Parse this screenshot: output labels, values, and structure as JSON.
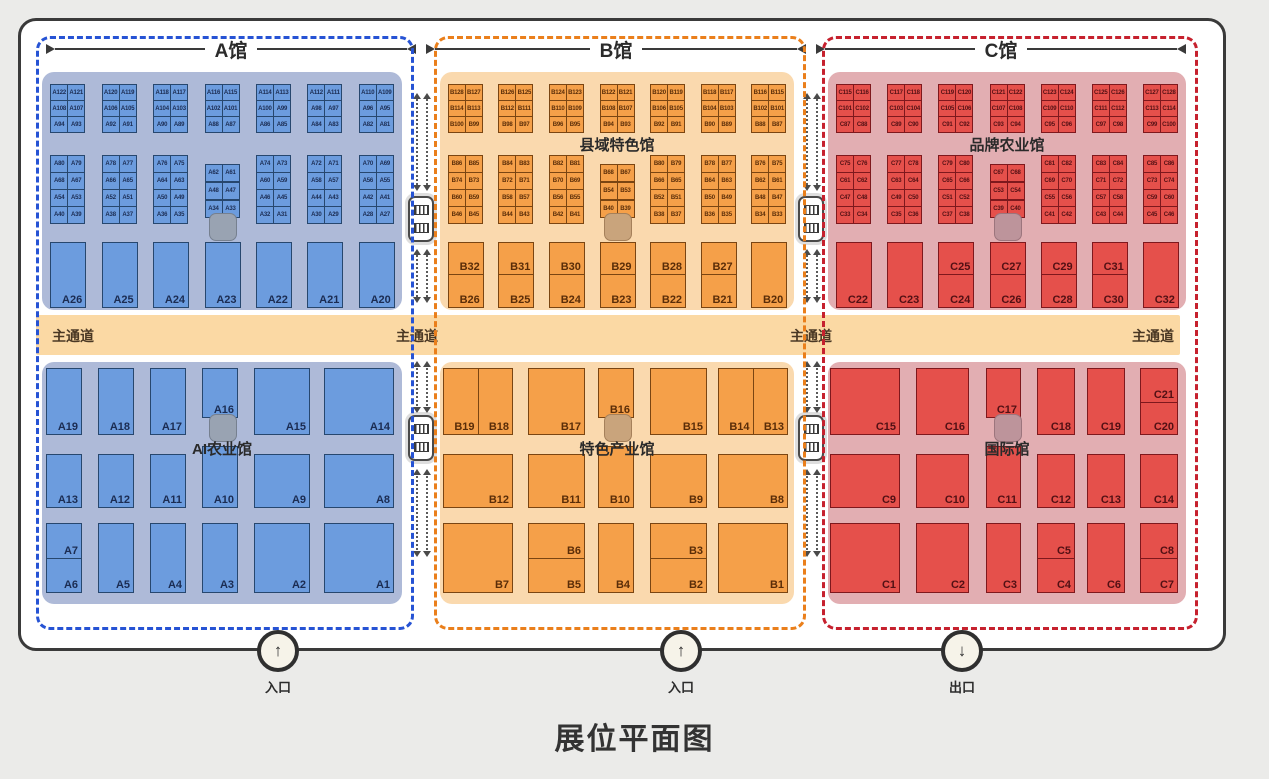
{
  "title": "展位平面图",
  "aisle": {
    "label": "主通道",
    "color": "#fbd9a4",
    "label_x": [
      16,
      360,
      754
    ],
    "label_right": 6
  },
  "corridors": {
    "x": [
      421,
      811
    ],
    "stairs_icon": "escalator-icon",
    "arrows_icon": "two-way-arrow-icon"
  },
  "entrances": [
    {
      "label": "入口",
      "direction": "up",
      "arrow": "↑",
      "x": 278
    },
    {
      "label": "入口",
      "direction": "up",
      "arrow": "↑",
      "x": 681
    },
    {
      "label": "出口",
      "direction": "down",
      "arrow": "↓",
      "x": 962
    }
  ],
  "halls": [
    {
      "id": "A",
      "name": "A馆",
      "x": 36,
      "w": 372,
      "colors": {
        "dash": "#2653d4",
        "region": "#aebad8",
        "booth": "#6c9cde",
        "booth_border": "#27476e",
        "text": "#1b2c52",
        "blob": "#99a3b2",
        "blob_border": "#76808f"
      },
      "top_hall_label": "",
      "bottom_hall_label": "AI农业馆",
      "cluster1_rows": [
        [
          "A122",
          "A121",
          "A120",
          "A119",
          "A118",
          "A117",
          "A116",
          "A115",
          "A114",
          "A113",
          "A112",
          "A111",
          "A110",
          "A109"
        ],
        [
          "A108",
          "A107",
          "A106",
          "A105",
          "A104",
          "A103",
          "A102",
          "A101",
          "A100",
          "A99",
          "A98",
          "A97",
          "A96",
          "A95"
        ],
        [
          "A94",
          "A93",
          "A92",
          "A91",
          "A90",
          "A89",
          "A88",
          "A87",
          "A86",
          "A85",
          "A84",
          "A83",
          "A82",
          "A81"
        ]
      ],
      "cluster2_rows": [
        [
          "A80",
          "A79",
          "A78",
          "A77",
          "A76",
          "A75",
          "A74",
          "A73",
          "A72",
          "A71",
          "A70",
          "A69"
        ],
        [
          "A68",
          "A67",
          "A66",
          "A65",
          "A64",
          "A63",
          "A60",
          "A59",
          "A58",
          "A57",
          "A56",
          "A55"
        ],
        [
          "A54",
          "A53",
          "A52",
          "A51",
          "A50",
          "A49",
          "A46",
          "A45",
          "A44",
          "A43",
          "A42",
          "A41"
        ],
        [
          "A40",
          "A39",
          "A38",
          "A37",
          "A36",
          "A35",
          "A32",
          "A31",
          "A30",
          "A29",
          "A28",
          "A27"
        ]
      ],
      "cluster2_middle": [
        [
          "A62",
          "A61"
        ],
        [
          "A48",
          "A47"
        ],
        [
          "A34",
          "A33"
        ]
      ],
      "big_row": [
        {
          "top": "",
          "bottom": "A26"
        },
        {
          "top": "",
          "bottom": "A25"
        },
        {
          "top": "",
          "bottom": "A24"
        },
        {
          "top": "",
          "bottom": "A23"
        },
        {
          "top": "",
          "bottom": "A22"
        },
        {
          "top": "",
          "bottom": "A21"
        },
        {
          "top": "",
          "bottom": "A20"
        }
      ],
      "bottom_cols": [
        {
          "x": 4,
          "w": 36
        },
        {
          "x": 56,
          "w": 36
        },
        {
          "x": 108,
          "w": 36
        },
        {
          "x": 160,
          "w": 36
        },
        {
          "x": 212,
          "w": 56
        },
        {
          "x": 282,
          "w": 70
        }
      ],
      "bottom_rows": [
        {
          "row": 0,
          "col": 0,
          "type": "full",
          "label": "A19"
        },
        {
          "row": 0,
          "col": 1,
          "type": "full",
          "label": "A18"
        },
        {
          "row": 0,
          "col": 2,
          "type": "full",
          "label": "A17"
        },
        {
          "row": 0,
          "col": 3,
          "type": "small",
          "label": "A16"
        },
        {
          "row": 0,
          "col": 4,
          "type": "full",
          "label": "A15"
        },
        {
          "row": 0,
          "col": 5,
          "type": "full",
          "label": "A14"
        },
        {
          "row": 1,
          "col": 0,
          "type": "full",
          "label": "A13"
        },
        {
          "row": 1,
          "col": 1,
          "type": "full",
          "label": "A12"
        },
        {
          "row": 1,
          "col": 2,
          "type": "full",
          "label": "A11"
        },
        {
          "row": 1,
          "col": 3,
          "type": "tall",
          "label": "A10"
        },
        {
          "row": 1,
          "col": 4,
          "type": "full",
          "label": "A9"
        },
        {
          "row": 1,
          "col": 5,
          "type": "full",
          "label": "A8"
        },
        {
          "row": 2,
          "col": 0,
          "type": "split_h",
          "labels": [
            "A7",
            "A6"
          ]
        },
        {
          "row": 2,
          "col": 1,
          "type": "full",
          "label": "A5"
        },
        {
          "row": 2,
          "col": 2,
          "type": "full",
          "label": "A4"
        },
        {
          "row": 2,
          "col": 3,
          "type": "full",
          "label": "A3"
        },
        {
          "row": 2,
          "col": 4,
          "type": "full",
          "label": "A2"
        },
        {
          "row": 2,
          "col": 5,
          "type": "full",
          "label": "A1"
        }
      ]
    },
    {
      "id": "B",
      "name": "B馆",
      "x": 434,
      "w": 366,
      "colors": {
        "dash": "#ea7f1b",
        "region": "#fad9ae",
        "booth": "#f5a049",
        "booth_border": "#7a4512",
        "text": "#5a2d08",
        "blob": "#c9a47c",
        "blob_border": "#a5805a"
      },
      "top_hall_label": "县域特色馆",
      "bottom_hall_label": "特色产业馆",
      "cluster1_rows": [
        [
          "B128",
          "B127",
          "B126",
          "B125",
          "B124",
          "B123",
          "B122",
          "B121",
          "B120",
          "B119",
          "B118",
          "B117",
          "B116",
          "B115"
        ],
        [
          "B114",
          "B113",
          "B112",
          "B111",
          "B110",
          "B109",
          "B108",
          "B107",
          "B106",
          "B105",
          "B104",
          "B103",
          "B102",
          "B101"
        ],
        [
          "B100",
          "B99",
          "B98",
          "B97",
          "B96",
          "B95",
          "B94",
          "B93",
          "B92",
          "B91",
          "B90",
          "B89",
          "B88",
          "B87"
        ]
      ],
      "cluster2_rows": [
        [
          "B86",
          "B85",
          "B84",
          "B83",
          "B82",
          "B81",
          "B80",
          "B79",
          "B78",
          "B77",
          "B76",
          "B75"
        ],
        [
          "B74",
          "B73",
          "B72",
          "B71",
          "B70",
          "B69",
          "B66",
          "B65",
          "B64",
          "B63",
          "B62",
          "B61"
        ],
        [
          "B60",
          "B59",
          "B58",
          "B57",
          "B56",
          "B55",
          "B52",
          "B51",
          "B50",
          "B49",
          "B48",
          "B47"
        ],
        [
          "B46",
          "B45",
          "B44",
          "B43",
          "B42",
          "B41",
          "B38",
          "B37",
          "B36",
          "B35",
          "B34",
          "B33"
        ]
      ],
      "cluster2_middle": [
        [
          "B68",
          "B67"
        ],
        [
          "B54",
          "B53"
        ],
        [
          "B40",
          "B39"
        ]
      ],
      "big_row": [
        {
          "top": "B32",
          "bottom": "B26"
        },
        {
          "top": "B31",
          "bottom": "B25"
        },
        {
          "top": "B30",
          "bottom": "B24"
        },
        {
          "top": "B29",
          "bottom": "B23"
        },
        {
          "top": "B28",
          "bottom": "B22"
        },
        {
          "top": "B27",
          "bottom": "B21"
        },
        {
          "top": "",
          "bottom": "B20"
        }
      ],
      "bottom_cols": [
        {
          "x": 3,
          "w": 70
        },
        {
          "x": 88,
          "w": 57
        },
        {
          "x": 158,
          "w": 36
        },
        {
          "x": 210,
          "w": 57
        },
        {
          "x": 278,
          "w": 70
        }
      ],
      "bottom_rows": [
        {
          "row": 0,
          "col": 0,
          "type": "split_v",
          "labels": [
            "B19",
            "B18"
          ]
        },
        {
          "row": 0,
          "col": 1,
          "type": "full",
          "label": "B17"
        },
        {
          "row": 0,
          "col": 2,
          "type": "small",
          "label": "B16"
        },
        {
          "row": 0,
          "col": 3,
          "type": "full",
          "label": "B15"
        },
        {
          "row": 0,
          "col": 4,
          "type": "split_v",
          "labels": [
            "B14",
            "B13"
          ]
        },
        {
          "row": 1,
          "col": 0,
          "type": "full",
          "label": "B12"
        },
        {
          "row": 1,
          "col": 1,
          "type": "full",
          "label": "B11"
        },
        {
          "row": 1,
          "col": 2,
          "type": "tall",
          "label": "B10"
        },
        {
          "row": 1,
          "col": 3,
          "type": "full",
          "label": "B9"
        },
        {
          "row": 1,
          "col": 4,
          "type": "full",
          "label": "B8"
        },
        {
          "row": 2,
          "col": 0,
          "type": "full",
          "label": "B7"
        },
        {
          "row": 2,
          "col": 1,
          "type": "split_h",
          "labels": [
            "B6",
            "B5"
          ]
        },
        {
          "row": 2,
          "col": 2,
          "type": "full",
          "label": "B4"
        },
        {
          "row": 2,
          "col": 3,
          "type": "split_h",
          "labels": [
            "B3",
            "B2"
          ]
        },
        {
          "row": 2,
          "col": 4,
          "type": "full",
          "label": "B1"
        }
      ]
    },
    {
      "id": "C",
      "name": "C馆",
      "x": 822,
      "w": 370,
      "colors": {
        "dash": "#c6212e",
        "region": "#e2aeb2",
        "booth": "#e5504b",
        "booth_border": "#7e181d",
        "text": "#521014",
        "blob": "#bd949b",
        "blob_border": "#9c757d"
      },
      "top_hall_label": "品牌农业馆",
      "bottom_hall_label": "国际馆",
      "cluster1_rows": [
        [
          "C115",
          "C116",
          "C117",
          "C118",
          "C119",
          "C120",
          "C121",
          "C122",
          "C123",
          "C124",
          "C125",
          "C126",
          "C127",
          "C128"
        ],
        [
          "C101",
          "C102",
          "C103",
          "C104",
          "C105",
          "C106",
          "C107",
          "C108",
          "C109",
          "C110",
          "C111",
          "C112",
          "C113",
          "C114"
        ],
        [
          "C87",
          "C88",
          "C89",
          "C90",
          "C91",
          "C92",
          "C93",
          "C94",
          "C95",
          "C96",
          "C97",
          "C98",
          "C99",
          "C100"
        ]
      ],
      "cluster2_rows": [
        [
          "C75",
          "C76",
          "C77",
          "C78",
          "C79",
          "C80",
          "C81",
          "C82",
          "C83",
          "C84",
          "C85",
          "C86"
        ],
        [
          "C61",
          "C62",
          "C63",
          "C64",
          "C65",
          "C66",
          "C69",
          "C70",
          "C71",
          "C72",
          "C73",
          "C74"
        ],
        [
          "C47",
          "C48",
          "C49",
          "C50",
          "C51",
          "C52",
          "C55",
          "C56",
          "C57",
          "C58",
          "C59",
          "C60"
        ],
        [
          "C33",
          "C34",
          "C35",
          "C36",
          "C37",
          "C38",
          "C41",
          "C42",
          "C43",
          "C44",
          "C45",
          "C46"
        ]
      ],
      "cluster2_middle": [
        [
          "C67",
          "C68"
        ],
        [
          "C53",
          "C54"
        ],
        [
          "C39",
          "C40"
        ]
      ],
      "big_row": [
        {
          "top": "",
          "bottom": "C22"
        },
        {
          "top": "",
          "bottom": "C23"
        },
        {
          "top": "C25",
          "bottom": "C24"
        },
        {
          "top": "C27",
          "bottom": "C26"
        },
        {
          "top": "C29",
          "bottom": "C28"
        },
        {
          "top": "C31",
          "bottom": "C30"
        },
        {
          "top": "",
          "bottom": "C32"
        }
      ],
      "bottom_cols": [
        {
          "x": 2,
          "w": 70
        },
        {
          "x": 88,
          "w": 53
        },
        {
          "x": 158,
          "w": 35
        },
        {
          "x": 209,
          "w": 38
        },
        {
          "x": 259,
          "w": 38
        },
        {
          "x": 312,
          "w": 38
        }
      ],
      "bottom_rows": [
        {
          "row": 0,
          "col": 0,
          "type": "full",
          "label": "C15"
        },
        {
          "row": 0,
          "col": 1,
          "type": "full",
          "label": "C16"
        },
        {
          "row": 0,
          "col": 2,
          "type": "small",
          "label": "C17"
        },
        {
          "row": 0,
          "col": 3,
          "type": "full",
          "label": "C18"
        },
        {
          "row": 0,
          "col": 4,
          "type": "full",
          "label": "C19"
        },
        {
          "row": 0,
          "col": 5,
          "type": "split_h",
          "labels": [
            "C21",
            "C20"
          ]
        },
        {
          "row": 1,
          "col": 0,
          "type": "full",
          "label": "C9"
        },
        {
          "row": 1,
          "col": 1,
          "type": "full",
          "label": "C10"
        },
        {
          "row": 1,
          "col": 2,
          "type": "tall",
          "label": "C11"
        },
        {
          "row": 1,
          "col": 3,
          "type": "full",
          "label": "C12"
        },
        {
          "row": 1,
          "col": 4,
          "type": "full",
          "label": "C13"
        },
        {
          "row": 1,
          "col": 5,
          "type": "full",
          "label": "C14"
        },
        {
          "row": 2,
          "col": 0,
          "type": "full",
          "label": "C1"
        },
        {
          "row": 2,
          "col": 1,
          "type": "full",
          "label": "C2"
        },
        {
          "row": 2,
          "col": 2,
          "type": "full",
          "label": "C3"
        },
        {
          "row": 2,
          "col": 3,
          "type": "split_h",
          "labels": [
            "C5",
            "C4"
          ]
        },
        {
          "row": 2,
          "col": 4,
          "type": "full",
          "label": "C6"
        },
        {
          "row": 2,
          "col": 5,
          "type": "split_h",
          "labels": [
            "C8",
            "C7"
          ]
        }
      ]
    }
  ]
}
